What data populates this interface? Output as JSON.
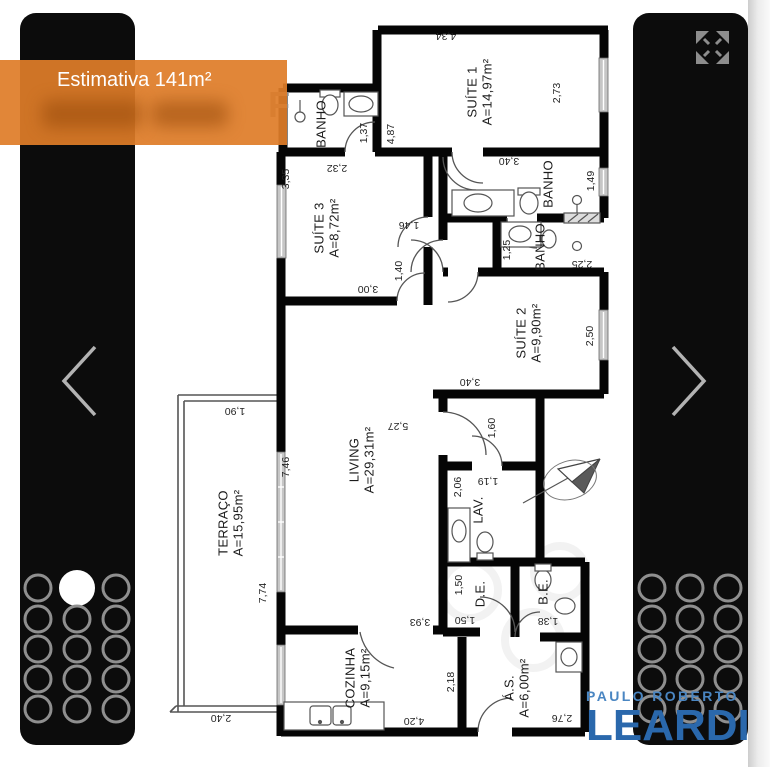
{
  "overlay": {
    "estimate": "Estimativa 141m²"
  },
  "watermark_letter": "F",
  "logo": {
    "line1": "PAULO ROBERTO",
    "line2": "LEARDI"
  },
  "colors": {
    "banner_orange": "#df7d29",
    "logo_blue": "#2a68ac",
    "logo_light_blue": "#4a86c2"
  },
  "plan": {
    "rooms": [
      {
        "id": "suite1",
        "name": "SUÍTE 1",
        "area": "A=14,97m²"
      },
      {
        "id": "suite3",
        "name": "SUÍTE 3",
        "area": "A=8,72m²"
      },
      {
        "id": "suite2",
        "name": "SUÍTE 2",
        "area": "A=9,90m²"
      },
      {
        "id": "living",
        "name": "LIVING",
        "area": "A=29,31m²"
      },
      {
        "id": "terraco",
        "name": "TERRAÇO",
        "area": "A=15,95m²"
      },
      {
        "id": "cozinha",
        "name": "COZINHA",
        "area": "A=9,15m²"
      },
      {
        "id": "as",
        "name": "Á.S.",
        "area": "A=6,00m²"
      },
      {
        "id": "banho_top",
        "name": "BANHO",
        "area": ""
      },
      {
        "id": "banho_s1",
        "name": "BANHO",
        "area": ""
      },
      {
        "id": "banho_s2",
        "name": "BANHO",
        "area": ""
      },
      {
        "id": "lav",
        "name": "LAV.",
        "area": ""
      },
      {
        "id": "de",
        "name": "D.E.",
        "area": ""
      },
      {
        "id": "be",
        "name": "B.E.",
        "area": ""
      }
    ],
    "dims": [
      {
        "id": "d434",
        "value": "4,34"
      },
      {
        "id": "d273",
        "value": "2,73"
      },
      {
        "id": "d487",
        "value": "4,87"
      },
      {
        "id": "d137",
        "value": "1,37"
      },
      {
        "id": "d335",
        "value": "3,35"
      },
      {
        "id": "d232",
        "value": "2,32"
      },
      {
        "id": "d340a",
        "value": "3,40"
      },
      {
        "id": "d149",
        "value": "1,49"
      },
      {
        "id": "d146",
        "value": "1,46"
      },
      {
        "id": "d125",
        "value": "1,25"
      },
      {
        "id": "d225",
        "value": "2,25"
      },
      {
        "id": "d300",
        "value": "3,00"
      },
      {
        "id": "d140",
        "value": "1,40"
      },
      {
        "id": "d340b",
        "value": "3,40"
      },
      {
        "id": "d250",
        "value": "2,50"
      },
      {
        "id": "d190",
        "value": "1,90"
      },
      {
        "id": "d746",
        "value": "7,46"
      },
      {
        "id": "d527",
        "value": "5,27"
      },
      {
        "id": "d160",
        "value": "1,60"
      },
      {
        "id": "d206",
        "value": "2,06"
      },
      {
        "id": "d119",
        "value": "1,19"
      },
      {
        "id": "d150a",
        "value": "1,50"
      },
      {
        "id": "d150b",
        "value": "1,50"
      },
      {
        "id": "d393",
        "value": "3,93"
      },
      {
        "id": "d138",
        "value": "1,38"
      },
      {
        "id": "d218",
        "value": "2,18"
      },
      {
        "id": "d420",
        "value": "4,20"
      },
      {
        "id": "d276",
        "value": "2,76"
      },
      {
        "id": "d240",
        "value": "2,40"
      },
      {
        "id": "d774",
        "value": "7,74"
      }
    ]
  },
  "gallery": {
    "left": {
      "cols": 3,
      "rows": 5,
      "active_row": 0,
      "active_col": 1
    },
    "right": {
      "cols": 3,
      "rows": 5,
      "active_row": -1,
      "active_col": -1
    }
  }
}
